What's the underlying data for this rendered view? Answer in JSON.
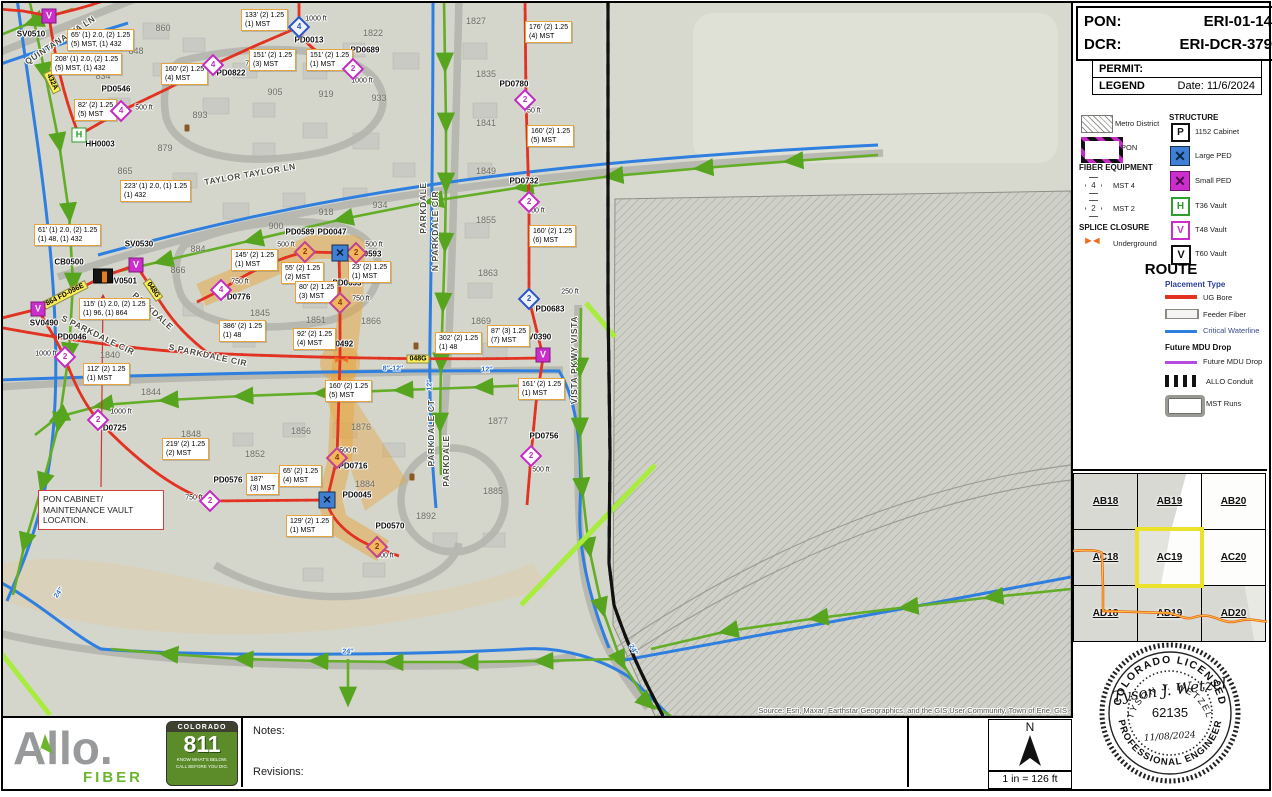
{
  "header": {
    "pon_label": "PON:",
    "pon_value": "ERI-01-14",
    "dcr_label": "DCR:",
    "dcr_value": "ERI-DCR-379",
    "permit_label": "PERMIT:",
    "legend_label": "LEGEND",
    "date": "Date: 11/6/2024"
  },
  "legend": {
    "metro_label": "Metro District",
    "pon_label": "PON",
    "fiber_equipment_title": "FIBER EQUIPMENT",
    "mst4_label": "MST 4",
    "mst4_num": "4",
    "mst2_label": "MST 2",
    "mst2_num": "2",
    "splice_title": "SPLICE CLOSURE",
    "underground_label": "Underground",
    "structure_title": "STRUCTURE",
    "structure": {
      "items": [
        {
          "icon": "P",
          "label": "1152 Cabinet"
        },
        {
          "icon": "X",
          "label": "Large PED"
        },
        {
          "icon": "X",
          "label": "Small PED"
        },
        {
          "icon": "H",
          "label": "T36 Vault"
        },
        {
          "icon": "V",
          "label": "T48 Vault"
        },
        {
          "icon": "V",
          "label": "T60 Vault"
        }
      ]
    },
    "route_title": "ROUTE",
    "placement_type": "Placement Type",
    "ug_bore": "UG Bore",
    "feeder": "Feeder Fiber",
    "waterline": "Critical Waterline",
    "future_title": "Future MDU Drop",
    "future_label": "Future MDU Drop",
    "conduit": "ALLO Conduit",
    "mst_runs": "MST Runs"
  },
  "grid_index": {
    "cells": [
      [
        "AB18",
        "AB19",
        "AB20"
      ],
      [
        "AC18",
        "AC19",
        "AC20"
      ],
      [
        "AD18",
        "AD19",
        "AD20"
      ]
    ],
    "highlighted": "AC19"
  },
  "stamp": {
    "top_arc": "COLORADO LICENSED",
    "bottom_arc": "PROFESSIONAL ENGINEER",
    "name_arc": "TYSON J. WETZEL",
    "number": "62135",
    "date": "11/08/2024",
    "signature": "Tyson J. Wetzel"
  },
  "footer": {
    "brand": "Allo.",
    "brand_sub": "FIBER",
    "c811_title": "COLORADO",
    "c811_number": "811",
    "c811_line1": "KNOW WHAT'S BELOW.",
    "c811_line2": "CALL BEFORE YOU DIG.",
    "notes_label": "Notes:",
    "revisions_label": "Revisions:",
    "north_label": "N",
    "scale": "1 in = 126 ft"
  },
  "map": {
    "source": "Source: Esri, Maxar, Earthstar Geographics, and the GIS User Community, Town of Erie, GIS",
    "note": {
      "line1": "PON CABINET/",
      "line2": "MAINTENANCE VAULT",
      "line3": "LOCATION."
    },
    "streets": [
      {
        "t": "QUINTANA WA LN",
        "x": 57,
        "y": 37,
        "r": -33
      },
      {
        "t": "TAYLOR  TAYLOR LN",
        "x": 247,
        "y": 171,
        "r": -10
      },
      {
        "t": "PARKDALE",
        "x": 420,
        "y": 205,
        "r": -90
      },
      {
        "t": "N PARKDALE CIR",
        "x": 432,
        "y": 228,
        "r": -90
      },
      {
        "t": "PARKDALE",
        "x": 150,
        "y": 308,
        "r": 42
      },
      {
        "t": "S PARKDALE CIR",
        "x": 95,
        "y": 332,
        "r": 26
      },
      {
        "t": "S PARKDALE CIR",
        "x": 205,
        "y": 352,
        "r": 12
      },
      {
        "t": "PARKDALE CT",
        "x": 428,
        "y": 430,
        "r": -90
      },
      {
        "t": "PARKDALE",
        "x": 443,
        "y": 458,
        "r": -90
      },
      {
        "t": "VISTA PKWY VISTA",
        "x": 571,
        "y": 357,
        "r": -90
      }
    ],
    "lots": [
      {
        "t": "860",
        "x": 160,
        "y": 25
      },
      {
        "t": "848",
        "x": 133,
        "y": 48
      },
      {
        "t": "834",
        "x": 100,
        "y": 73
      },
      {
        "t": "893",
        "x": 197,
        "y": 112
      },
      {
        "t": "879",
        "x": 162,
        "y": 145
      },
      {
        "t": "865",
        "x": 122,
        "y": 168
      },
      {
        "t": "905",
        "x": 272,
        "y": 89
      },
      {
        "t": "919",
        "x": 323,
        "y": 91
      },
      {
        "t": "933",
        "x": 376,
        "y": 95
      },
      {
        "t": "1822",
        "x": 370,
        "y": 30
      },
      {
        "t": "1827",
        "x": 473,
        "y": 18
      },
      {
        "t": "1835",
        "x": 483,
        "y": 71
      },
      {
        "t": "1841",
        "x": 483,
        "y": 120
      },
      {
        "t": "918",
        "x": 323,
        "y": 209
      },
      {
        "t": "934",
        "x": 377,
        "y": 202
      },
      {
        "t": "900",
        "x": 273,
        "y": 223
      },
      {
        "t": "884",
        "x": 195,
        "y": 246
      },
      {
        "t": "866",
        "x": 175,
        "y": 267
      },
      {
        "t": "1849",
        "x": 483,
        "y": 168
      },
      {
        "t": "1855",
        "x": 483,
        "y": 217
      },
      {
        "t": "1863",
        "x": 485,
        "y": 270
      },
      {
        "t": "1845",
        "x": 257,
        "y": 310
      },
      {
        "t": "1851",
        "x": 313,
        "y": 317
      },
      {
        "t": "1866",
        "x": 368,
        "y": 318
      },
      {
        "t": "1869",
        "x": 478,
        "y": 318
      },
      {
        "t": "1840",
        "x": 107,
        "y": 352
      },
      {
        "t": "1844",
        "x": 148,
        "y": 389
      },
      {
        "t": "1848",
        "x": 188,
        "y": 431
      },
      {
        "t": "1852",
        "x": 252,
        "y": 451
      },
      {
        "t": "1856",
        "x": 298,
        "y": 428
      },
      {
        "t": "1876",
        "x": 358,
        "y": 424
      },
      {
        "t": "1877",
        "x": 495,
        "y": 418
      },
      {
        "t": "1884",
        "x": 362,
        "y": 481
      },
      {
        "t": "1885",
        "x": 490,
        "y": 488
      },
      {
        "t": "1892",
        "x": 423,
        "y": 513
      }
    ],
    "devices": [
      {
        "t": "SV0510",
        "x": 28,
        "y": 31
      },
      {
        "t": "PD0546",
        "x": 113,
        "y": 86
      },
      {
        "t": "HH0003",
        "x": 97,
        "y": 141
      },
      {
        "t": "PD0822",
        "x": 228,
        "y": 70
      },
      {
        "t": "PD0013",
        "x": 306,
        "y": 37
      },
      {
        "t": "PD0689",
        "x": 362,
        "y": 47
      },
      {
        "t": "PD0780",
        "x": 511,
        "y": 81
      },
      {
        "t": "PD0732",
        "x": 521,
        "y": 178
      },
      {
        "t": "PD0683",
        "x": 547,
        "y": 306
      },
      {
        "t": "SV0390",
        "x": 534,
        "y": 334
      },
      {
        "t": "PD0756",
        "x": 541,
        "y": 433
      },
      {
        "t": "PD0589",
        "x": 297,
        "y": 229
      },
      {
        "t": "PD0047",
        "x": 329,
        "y": 229
      },
      {
        "t": "PD0593",
        "x": 364,
        "y": 251
      },
      {
        "t": "PD0653",
        "x": 344,
        "y": 280
      },
      {
        "t": "PD0776",
        "x": 233,
        "y": 294
      },
      {
        "t": "SV0492",
        "x": 336,
        "y": 341
      },
      {
        "t": "SV0530",
        "x": 136,
        "y": 241
      },
      {
        "t": "CB0500",
        "x": 66,
        "y": 259
      },
      {
        "t": "MV0501",
        "x": 119,
        "y": 278
      },
      {
        "t": "SV0490",
        "x": 41,
        "y": 320
      },
      {
        "t": "PD0046",
        "x": 69,
        "y": 334
      },
      {
        "t": "PD0725",
        "x": 109,
        "y": 425
      },
      {
        "t": "PD0576",
        "x": 225,
        "y": 477
      },
      {
        "t": "PD0716",
        "x": 350,
        "y": 463
      },
      {
        "t": "PD0045",
        "x": 354,
        "y": 492
      },
      {
        "t": "PD0570",
        "x": 387,
        "y": 523
      }
    ],
    "distances": [
      {
        "t": "750 ft",
        "x": 251,
        "y": 61
      },
      {
        "t": "1000 ft",
        "x": 313,
        "y": 16
      },
      {
        "t": "1000 ft",
        "x": 359,
        "y": 78
      },
      {
        "t": "500 ft",
        "x": 141,
        "y": 105
      },
      {
        "t": "750 ft",
        "x": 529,
        "y": 108
      },
      {
        "t": "500 ft",
        "x": 533,
        "y": 208
      },
      {
        "t": "250 ft",
        "x": 567,
        "y": 289
      },
      {
        "t": "500 ft",
        "x": 283,
        "y": 242
      },
      {
        "t": "500 ft",
        "x": 371,
        "y": 242
      },
      {
        "t": "750 ft",
        "x": 237,
        "y": 279
      },
      {
        "t": "750 ft",
        "x": 358,
        "y": 296
      },
      {
        "t": "1000 ft",
        "x": 43,
        "y": 351
      },
      {
        "t": "1000 ft",
        "x": 118,
        "y": 409
      },
      {
        "t": "750 ft",
        "x": 191,
        "y": 495
      },
      {
        "t": "500 ft",
        "x": 345,
        "y": 448
      },
      {
        "t": "500 ft",
        "x": 382,
        "y": 553
      },
      {
        "t": "500 ft",
        "x": 538,
        "y": 467
      }
    ],
    "pipes": [
      {
        "t": "8″",
        "x": 40,
        "y": 228,
        "r": -75
      },
      {
        "t": "8″-12″",
        "x": 390,
        "y": 366,
        "r": 0
      },
      {
        "t": "12″",
        "x": 484,
        "y": 367,
        "r": 0
      },
      {
        "t": "12″",
        "x": 427,
        "y": 382,
        "r": -90
      },
      {
        "t": "24″",
        "x": 56,
        "y": 590,
        "r": -55
      },
      {
        "t": "24″",
        "x": 345,
        "y": 649,
        "r": 0
      },
      {
        "t": "24″",
        "x": 630,
        "y": 647,
        "r": 62
      }
    ],
    "badges": [
      {
        "t": "432A",
        "x": 49,
        "y": 79,
        "r": 64
      },
      {
        "t": "048G",
        "x": 150,
        "y": 287,
        "r": 55
      },
      {
        "t": "048G",
        "x": 415,
        "y": 356,
        "r": 0
      },
      {
        "t": "864 FD-096E",
        "x": 62,
        "y": 292,
        "r": -27
      }
    ],
    "callouts": [
      {
        "x": 238,
        "y": 6,
        "l1": "133' (2) 1.25",
        "l2": "(1) MST"
      },
      {
        "x": 64,
        "y": 26,
        "l1": "65' (1) 2.0, (2) 1.25",
        "l2": "(5) MST, (1) 432"
      },
      {
        "x": 48,
        "y": 50,
        "l1": "208' (1) 2.0, (2) 1.25",
        "l2": "(5) MST, (1) 432"
      },
      {
        "x": 246,
        "y": 46,
        "l1": "151' (2) 1.25",
        "l2": "(3) MST"
      },
      {
        "x": 303,
        "y": 46,
        "l1": "151' (2) 1.25",
        "l2": "(1) MST"
      },
      {
        "x": 158,
        "y": 60,
        "l1": "160' (2) 1.25",
        "l2": "(4) MST"
      },
      {
        "x": 522,
        "y": 18,
        "l1": "176' (2) 1.25",
        "l2": "(4) MST"
      },
      {
        "x": 71,
        "y": 96,
        "l1": "82' (2) 1.25",
        "l2": "(5) MST"
      },
      {
        "x": 117,
        "y": 177,
        "l1": "223' (1) 2.0, (1) 1.25",
        "l2": "(1) 432"
      },
      {
        "x": 31,
        "y": 221,
        "l1": "61' (1) 2.0, (2) 1.25",
        "l2": "(1) 48, (1) 432"
      },
      {
        "x": 76,
        "y": 295,
        "l1": "115' (1) 2.0, (2) 1.25",
        "l2": "(1) 96, (1) 864"
      },
      {
        "x": 80,
        "y": 360,
        "l1": "112' (2) 1.25",
        "l2": "(1) MST"
      },
      {
        "x": 159,
        "y": 435,
        "l1": "219' (2) 1.25",
        "l2": "(2) MST"
      },
      {
        "x": 243,
        "y": 470,
        "l1": "187'",
        "l2": "(3) MST"
      },
      {
        "x": 276,
        "y": 462,
        "l1": "65' (2) 1.25",
        "l2": "(4) MST"
      },
      {
        "x": 283,
        "y": 512,
        "l1": "129' (2) 1.25",
        "l2": "(1) MST"
      },
      {
        "x": 228,
        "y": 246,
        "l1": "145' (2) 1.25",
        "l2": "(1) MST"
      },
      {
        "x": 278,
        "y": 259,
        "l1": "55' (2) 1.25",
        "l2": "(2) MST"
      },
      {
        "x": 345,
        "y": 258,
        "l1": "23' (2) 1.25",
        "l2": "(1) MST"
      },
      {
        "x": 292,
        "y": 278,
        "l1": "80' (2) 1.25",
        "l2": "(3) MST"
      },
      {
        "x": 216,
        "y": 317,
        "l1": "386' (2) 1.25",
        "l2": "(1) 48"
      },
      {
        "x": 290,
        "y": 325,
        "l1": "92' (2) 1.25",
        "l2": "(4) MST"
      },
      {
        "x": 432,
        "y": 329,
        "l1": "302' (2) 1.25",
        "l2": "(1) 48"
      },
      {
        "x": 484,
        "y": 322,
        "l1": "87' (3) 1.25",
        "l2": "(7) MST"
      },
      {
        "x": 322,
        "y": 377,
        "l1": "160' (2) 1.25",
        "l2": "(5) MST"
      },
      {
        "x": 515,
        "y": 375,
        "l1": "161' (2) 1.25",
        "l2": "(1) MST"
      },
      {
        "x": 524,
        "y": 122,
        "l1": "160' (2) 1.25",
        "l2": "(5) MST"
      },
      {
        "x": 526,
        "y": 222,
        "l1": "160' (2) 1.25",
        "l2": "(6) MST"
      }
    ],
    "markers": [
      {
        "x": 46,
        "y": 13,
        "k": "vv"
      },
      {
        "x": 35,
        "y": 306,
        "k": "vv"
      },
      {
        "x": 133,
        "y": 262,
        "k": "vv"
      },
      {
        "x": 540,
        "y": 352,
        "k": "vv"
      },
      {
        "x": 76,
        "y": 132,
        "k": "vh"
      },
      {
        "x": 118,
        "y": 108,
        "k": "d4m"
      },
      {
        "x": 210,
        "y": 62,
        "k": "d4m"
      },
      {
        "x": 218,
        "y": 287,
        "k": "d4m"
      },
      {
        "x": 337,
        "y": 300,
        "k": "d4o"
      },
      {
        "x": 334,
        "y": 455,
        "k": "d4o"
      },
      {
        "x": 350,
        "y": 66,
        "k": "d2m"
      },
      {
        "x": 522,
        "y": 97,
        "k": "d2m"
      },
      {
        "x": 526,
        "y": 199,
        "k": "d2m"
      },
      {
        "x": 62,
        "y": 354,
        "k": "d2m"
      },
      {
        "x": 95,
        "y": 417,
        "k": "d2m"
      },
      {
        "x": 207,
        "y": 498,
        "k": "d2m"
      },
      {
        "x": 528,
        "y": 453,
        "k": "d2m"
      },
      {
        "x": 302,
        "y": 249,
        "k": "d2o"
      },
      {
        "x": 353,
        "y": 250,
        "k": "d2o"
      },
      {
        "x": 374,
        "y": 544,
        "k": "d2o"
      },
      {
        "x": 296,
        "y": 24,
        "k": "d4b"
      },
      {
        "x": 526,
        "y": 296,
        "k": "d2b"
      },
      {
        "x": 337,
        "y": 250,
        "k": "xl"
      },
      {
        "x": 324,
        "y": 497,
        "k": "xl"
      },
      {
        "x": 337,
        "y": 357,
        "k": "bow"
      },
      {
        "x": 100,
        "y": 273,
        "k": "cab"
      },
      {
        "x": 184,
        "y": 125,
        "k": "hyd"
      },
      {
        "x": 413,
        "y": 343,
        "k": "hyd"
      },
      {
        "x": 409,
        "y": 474,
        "k": "hyd"
      }
    ]
  }
}
